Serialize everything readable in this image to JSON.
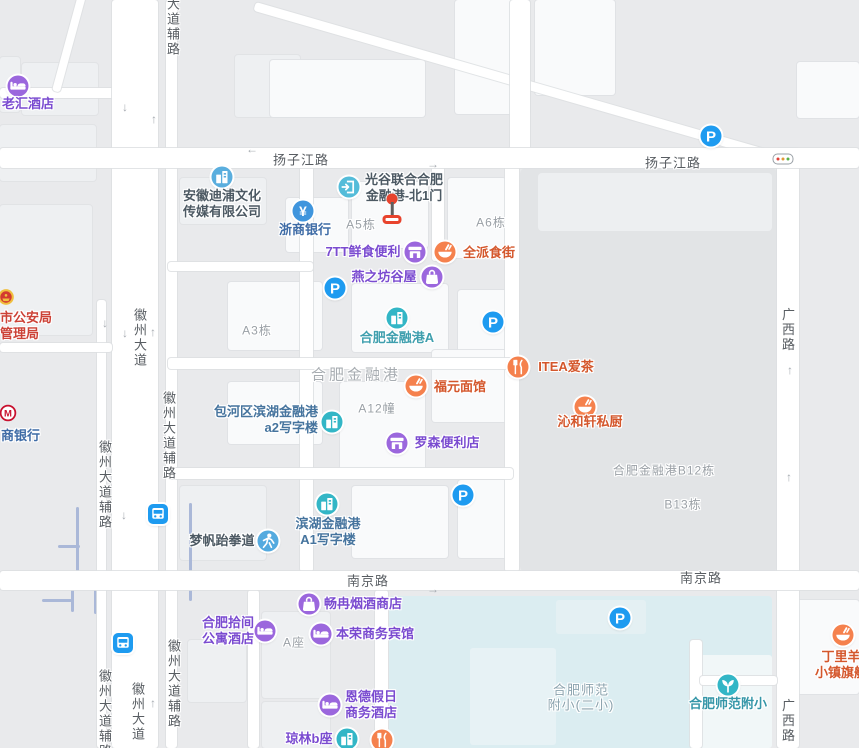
{
  "colors": {
    "purple": "#9b67dd",
    "purple_text": "#7a4bd0",
    "orange": "#f5814d",
    "orange_text": "#d4572c",
    "pblue": "#1e9bf0",
    "teal": "#33b6c6",
    "gateblue": "#54bcd9",
    "cobalt": "#5aaede",
    "bankblue": "#3f95dd",
    "skyblue": "#54aadf",
    "office_text": "#46749e",
    "bank_text": "#3f6ca6",
    "dark_text": "#4c5963",
    "teal_text": "#3f9fae",
    "school_poi_text": "#3596a8",
    "red_text": "#cc4237",
    "area_text": "#9aa0a6",
    "road_text": "#585d62",
    "map_bg": "#e9eaec",
    "block_dark": "#e2e4e6",
    "block_light": "#edeff1",
    "water": "#dbedf1"
  },
  "map": {
    "blocks": [
      {
        "x": 520,
        "y": 168,
        "w": 257,
        "h": 404,
        "c": "#e2e4e6",
        "r": 6
      },
      {
        "x": 538,
        "y": 173,
        "w": 234,
        "h": 58,
        "c": "#edeff1",
        "r": 4
      }
    ],
    "water": [
      {
        "x": 389,
        "y": 596,
        "w": 383,
        "h": 152,
        "c": "#dbedf1",
        "r": 4
      },
      {
        "x": 700,
        "y": 655,
        "w": 72,
        "h": 93,
        "c": "#f1f7f8",
        "r": 3
      },
      {
        "x": 470,
        "y": 648,
        "w": 86,
        "h": 97,
        "c": "#e7f2f5",
        "r": 3
      },
      {
        "x": 556,
        "y": 600,
        "w": 90,
        "h": 34,
        "c": "#e4f0f3",
        "r": 3
      }
    ],
    "buildings": [
      {
        "x": 180,
        "y": 178,
        "w": 86,
        "h": 46,
        "t": 2
      },
      {
        "x": 286,
        "y": 198,
        "w": 62,
        "h": 54,
        "t": 1
      },
      {
        "x": 352,
        "y": 182,
        "w": 76,
        "h": 66,
        "t": 1
      },
      {
        "x": 448,
        "y": 178,
        "w": 58,
        "h": 80,
        "t": 1
      },
      {
        "x": 228,
        "y": 282,
        "w": 94,
        "h": 68,
        "t": 1
      },
      {
        "x": 352,
        "y": 284,
        "w": 96,
        "h": 68,
        "t": 1
      },
      {
        "x": 458,
        "y": 290,
        "w": 54,
        "h": 62,
        "t": 1
      },
      {
        "x": 228,
        "y": 382,
        "w": 94,
        "h": 62,
        "t": 1
      },
      {
        "x": 340,
        "y": 382,
        "w": 85,
        "h": 88,
        "t": 1
      },
      {
        "x": 432,
        "y": 350,
        "w": 86,
        "h": 72,
        "t": 1
      },
      {
        "x": 352,
        "y": 486,
        "w": 96,
        "h": 72,
        "t": 1
      },
      {
        "x": 458,
        "y": 480,
        "w": 57,
        "h": 78,
        "t": 1
      },
      {
        "x": 180,
        "y": 486,
        "w": 86,
        "h": 74,
        "t": 2
      },
      {
        "x": 262,
        "y": 612,
        "w": 68,
        "h": 86,
        "t": 2
      },
      {
        "x": 262,
        "y": 702,
        "w": 68,
        "h": 46,
        "t": 2
      },
      {
        "x": 188,
        "y": 640,
        "w": 58,
        "h": 62,
        "t": 2
      },
      {
        "x": 0,
        "y": 57,
        "w": 20,
        "h": 55,
        "t": 2
      },
      {
        "x": 22,
        "y": 63,
        "w": 76,
        "h": 52,
        "t": 2
      },
      {
        "x": 235,
        "y": 55,
        "w": 65,
        "h": 62,
        "t": 2
      },
      {
        "x": 0,
        "y": 125,
        "w": 96,
        "h": 56,
        "t": 2
      },
      {
        "x": 270,
        "y": 60,
        "w": 155,
        "h": 57,
        "t": 1
      },
      {
        "x": 455,
        "y": 0,
        "w": 75,
        "h": 114,
        "t": 1
      },
      {
        "x": 535,
        "y": 0,
        "w": 80,
        "h": 95,
        "t": 1
      },
      {
        "x": 797,
        "y": 62,
        "w": 62,
        "h": 56,
        "t": 1
      },
      {
        "x": 795,
        "y": 600,
        "w": 64,
        "h": 94,
        "t": 1
      },
      {
        "x": 0,
        "y": 205,
        "w": 92,
        "h": 130,
        "t": 2
      }
    ],
    "paths_light": [
      {
        "x": 42,
        "y": 576,
        "len": 176,
        "v": false
      },
      {
        "x": 58,
        "y": 546,
        "len": 22,
        "v": false
      },
      {
        "x": 42,
        "y": 600,
        "len": 30,
        "v": false
      },
      {
        "x": 77,
        "y": 507,
        "len": 70,
        "v": true
      },
      {
        "x": 147,
        "y": 547,
        "len": 30,
        "v": true
      },
      {
        "x": 190,
        "y": 503,
        "len": 98,
        "v": true
      },
      {
        "x": 95,
        "y": 576,
        "len": 38,
        "v": true
      },
      {
        "x": 72,
        "y": 578,
        "len": 34,
        "v": true
      },
      {
        "x": 122,
        "y": 562,
        "len": 15,
        "v": true
      }
    ],
    "roads": [
      {
        "x": 0,
        "y": 88,
        "w": 118,
        "h": 10
      },
      {
        "x": 86,
        "y": -4,
        "w": 100,
        "h": 8,
        "rot": 105.2
      },
      {
        "x": 256,
        "y": 2,
        "w": 556,
        "h": 9,
        "rot": 16.1
      },
      {
        "x": 510,
        "y": 0,
        "w": 20,
        "h": 150
      },
      {
        "x": 112,
        "y": 0,
        "w": 46,
        "h": 748
      },
      {
        "x": 166,
        "y": 0,
        "w": 11,
        "h": 748
      },
      {
        "x": 97,
        "y": 300,
        "w": 9,
        "h": 448
      },
      {
        "x": 0,
        "y": 343,
        "w": 112,
        "h": 9
      },
      {
        "x": 777,
        "y": 148,
        "w": 22,
        "h": 600
      },
      {
        "x": 300,
        "y": 166,
        "w": 13,
        "h": 406
      },
      {
        "x": 505,
        "y": 166,
        "w": 14,
        "h": 406
      },
      {
        "x": 432,
        "y": 166,
        "w": 12,
        "h": 95
      },
      {
        "x": 168,
        "y": 262,
        "w": 145,
        "h": 9
      },
      {
        "x": 168,
        "y": 358,
        "w": 345,
        "h": 11
      },
      {
        "x": 168,
        "y": 468,
        "w": 345,
        "h": 11
      },
      {
        "x": 375,
        "y": 590,
        "w": 13,
        "h": 158
      },
      {
        "x": 248,
        "y": 590,
        "w": 11,
        "h": 158
      },
      {
        "x": 690,
        "y": 640,
        "w": 12,
        "h": 108
      },
      {
        "x": 700,
        "y": 676,
        "w": 77,
        "h": 9
      },
      {
        "x": 0,
        "y": 148,
        "w": 859,
        "h": 20
      },
      {
        "x": 0,
        "y": 571,
        "w": 859,
        "h": 19
      }
    ],
    "road_labels": [
      {
        "text": "扬子江路",
        "x": 301,
        "y": 159,
        "vert": false
      },
      {
        "text": "扬子江路",
        "x": 673,
        "y": 162,
        "vert": false
      },
      {
        "text": "南京路",
        "x": 368,
        "y": 580,
        "vert": false
      },
      {
        "text": "南京路",
        "x": 701,
        "y": 577,
        "vert": false
      },
      {
        "text": "大道辅路",
        "x": 172,
        "y": 27,
        "vert": true
      },
      {
        "text": "徽州大道",
        "x": 139,
        "y": 338,
        "vert": true
      },
      {
        "text": "徽州大道辅路",
        "x": 168,
        "y": 436,
        "vert": true
      },
      {
        "text": "徽州大道辅路",
        "x": 104,
        "y": 485,
        "vert": true
      },
      {
        "text": "徽州大道辅路",
        "x": 173,
        "y": 684,
        "vert": true
      },
      {
        "text": "徽州大道",
        "x": 137,
        "y": 712,
        "vert": true
      },
      {
        "text": "徽州大道辅路",
        "x": 104,
        "y": 714,
        "vert": true
      },
      {
        "text": "广西路",
        "x": 787,
        "y": 330,
        "vert": true
      },
      {
        "text": "广西路",
        "x": 787,
        "y": 721,
        "vert": true
      }
    ],
    "area_labels": [
      {
        "text": "A5栋",
        "x": 361,
        "y": 224,
        "cls": ""
      },
      {
        "text": "A6栋",
        "x": 491,
        "y": 222,
        "cls": ""
      },
      {
        "text": "A3栋",
        "x": 257,
        "y": 330,
        "cls": ""
      },
      {
        "text": "A12幢",
        "x": 377,
        "y": 408,
        "cls": ""
      },
      {
        "text": "A座",
        "x": 294,
        "y": 642,
        "cls": ""
      },
      {
        "text": "合肥金融港",
        "x": 356,
        "y": 374,
        "cls": "big"
      },
      {
        "text": "合肥金融港B12栋",
        "x": 664,
        "y": 470,
        "cls": ""
      },
      {
        "text": "B13栋",
        "x": 683,
        "y": 504,
        "cls": ""
      },
      {
        "text": "合肥师范",
        "x": 581,
        "y": 689,
        "cls": "school"
      },
      {
        "text": "附小(二小)",
        "x": 581,
        "y": 704,
        "cls": "school"
      }
    ],
    "arrows": [
      {
        "x": 125,
        "y": 107,
        "d": "down"
      },
      {
        "x": 154,
        "y": 119,
        "d": "up"
      },
      {
        "x": 252,
        "y": 149,
        "d": "left"
      },
      {
        "x": 433,
        "y": 164,
        "d": "right"
      },
      {
        "x": 105,
        "y": 323,
        "d": "down"
      },
      {
        "x": 125,
        "y": 333,
        "d": "down"
      },
      {
        "x": 153,
        "y": 332,
        "d": "up"
      },
      {
        "x": 124,
        "y": 515,
        "d": "down"
      },
      {
        "x": 153,
        "y": 703,
        "d": "up"
      },
      {
        "x": 789,
        "y": 477,
        "d": "up"
      },
      {
        "x": 790,
        "y": 370,
        "d": "up"
      },
      {
        "x": 433,
        "y": 589,
        "d": "right"
      }
    ],
    "pois": [
      {
        "name": "laohui-hotel",
        "icon": "bed",
        "bg": "purple",
        "x": 18,
        "y": 86,
        "label": [
          "老汇酒店"
        ],
        "align": "center",
        "lx": 28,
        "ly": 104,
        "tc": "purple_text"
      },
      {
        "name": "anhui-dipu-culture-media",
        "icon": "building",
        "bg": "cobalt",
        "x": 222,
        "y": 177,
        "label": [
          "安徽迪浦文化",
          "传媒有限公司"
        ],
        "align": "center",
        "lx": 222,
        "ly": 196,
        "tc": "dark_text"
      },
      {
        "name": "zheshang-bank",
        "icon": "yen",
        "bg": "bankblue",
        "x": 303,
        "y": 211,
        "label": [
          "浙商银行"
        ],
        "align": "center",
        "lx": 305,
        "ly": 230,
        "tc": "bank_text"
      },
      {
        "name": "guanggu-united-north-gate1",
        "icon": "gate",
        "bg": "gateblue",
        "x": 349,
        "y": 187,
        "label": [
          "光谷联合合肥",
          "金融港-北1门"
        ],
        "align": "center",
        "lx": 404,
        "ly": 180,
        "tc": "dark_text"
      },
      {
        "name": "7tt-fresh-food-store",
        "icon": "store",
        "bg": "purple",
        "x": 415,
        "y": 252,
        "label": [
          "7TT鲜食便利"
        ],
        "align": "center",
        "lx": 363,
        "ly": 252,
        "tc": "purple_text"
      },
      {
        "name": "quanpai-food-street",
        "icon": "bowl",
        "bg": "orange",
        "x": 445,
        "y": 252,
        "label": [
          "全派食街"
        ],
        "align": "center",
        "lx": 489,
        "ly": 253,
        "tc": "orange_text"
      },
      {
        "name": "yanzhifang-guwu",
        "icon": "bag",
        "bg": "purple",
        "x": 432,
        "y": 277,
        "label": [
          "燕之坊谷屋"
        ],
        "align": "center",
        "lx": 384,
        "ly": 277,
        "tc": "purple_text"
      },
      {
        "name": "parking-1",
        "icon": "pletter",
        "bg": "pblue",
        "x": 335,
        "y": 288,
        "label": []
      },
      {
        "name": "parking-2",
        "icon": "pletter",
        "bg": "pblue",
        "x": 493,
        "y": 322,
        "label": []
      },
      {
        "name": "hefei-financial-port-a",
        "icon": "building",
        "bg": "teal",
        "x": 397,
        "y": 318,
        "label": [
          "合肥金融港A"
        ],
        "align": "center",
        "lx": 397,
        "ly": 338,
        "tc": "teal_text"
      },
      {
        "name": "fuyuan-noodle-house",
        "icon": "bowl",
        "bg": "orange",
        "x": 416,
        "y": 386,
        "label": [
          "福元面馆"
        ],
        "align": "center",
        "lx": 460,
        "ly": 387,
        "tc": "orange_text"
      },
      {
        "name": "itea-aicha",
        "icon": "forkknife",
        "bg": "orange",
        "x": 518,
        "y": 367,
        "label": [
          "ITEA爱茶"
        ],
        "align": "center",
        "lx": 566,
        "ly": 367,
        "tc": "orange_text"
      },
      {
        "name": "qinhexuan-private-kitchen",
        "icon": "bowl",
        "bg": "orange",
        "x": 585,
        "y": 407,
        "label": [
          "沁和轩私厨"
        ],
        "align": "center",
        "lx": 590,
        "ly": 422,
        "tc": "orange_text"
      },
      {
        "name": "lawson-store",
        "icon": "store",
        "bg": "purple",
        "x": 397,
        "y": 443,
        "label": [
          "罗森便利店"
        ],
        "align": "center",
        "lx": 447,
        "ly": 443,
        "tc": "purple_text"
      },
      {
        "name": "baohe-binhu-a2-office",
        "icon": "building",
        "bg": "teal",
        "x": 332,
        "y": 422,
        "label": [
          "包河区滨湖金融港",
          "a2写字楼"
        ],
        "align": "right",
        "lx": 318,
        "ly": 412,
        "tc": "office_text"
      },
      {
        "name": "binhu-a1-office",
        "icon": "building",
        "bg": "teal",
        "x": 327,
        "y": 504,
        "label": [
          "滨湖金融港",
          "A1写字楼"
        ],
        "align": "center",
        "lx": 328,
        "ly": 524,
        "tc": "office_text"
      },
      {
        "name": "mengfan-taekwondo",
        "icon": "person",
        "bg": "skyblue",
        "x": 268,
        "y": 541,
        "label": [
          "梦帆跆拳道"
        ],
        "align": "center",
        "lx": 222,
        "ly": 541,
        "tc": "dark_text"
      },
      {
        "name": "parking-3",
        "icon": "pletter",
        "bg": "pblue",
        "x": 463,
        "y": 495,
        "label": []
      },
      {
        "name": "parking-4",
        "icon": "pletter",
        "bg": "pblue",
        "x": 711,
        "y": 136,
        "label": []
      },
      {
        "name": "parking-5",
        "icon": "pletter",
        "bg": "pblue",
        "x": 620,
        "y": 618,
        "label": []
      },
      {
        "name": "bus-station-1",
        "icon": "bus",
        "bg": "pblue",
        "x": 158,
        "y": 514,
        "shape": "square",
        "label": []
      },
      {
        "name": "bus-station-2",
        "icon": "bus",
        "bg": "pblue",
        "x": 123,
        "y": 643,
        "shape": "square",
        "label": []
      },
      {
        "name": "changran-tobacco-wine-shop",
        "icon": "bag",
        "bg": "purple",
        "x": 309,
        "y": 604,
        "label": [
          "畅冉烟酒商店"
        ],
        "align": "center",
        "lx": 363,
        "ly": 604,
        "tc": "purple_text"
      },
      {
        "name": "hefei-shijian-apartment-hotel",
        "icon": "bed",
        "bg": "purple",
        "x": 265,
        "y": 631,
        "label": [
          "合肥拾间",
          "公寓酒店"
        ],
        "align": "center",
        "lx": 228,
        "ly": 623,
        "tc": "purple_text"
      },
      {
        "name": "benrong-business-hotel",
        "icon": "bed",
        "bg": "purple",
        "x": 321,
        "y": 634,
        "label": [
          "本荣商务宾馆"
        ],
        "align": "center",
        "lx": 375,
        "ly": 634,
        "tc": "purple_text"
      },
      {
        "name": "ende-holiday-business-hotel",
        "icon": "bed",
        "bg": "purple",
        "x": 330,
        "y": 705,
        "label": [
          "恩德假日",
          "商务酒店"
        ],
        "align": "center",
        "lx": 371,
        "ly": 697,
        "tc": "purple_text"
      },
      {
        "name": "qionglin-b-block",
        "icon": "building",
        "bg": "teal",
        "x": 347,
        "y": 739,
        "label": [
          "琼林b座"
        ],
        "align": "center",
        "lx": 309,
        "ly": 739,
        "tc": "purple_text"
      },
      {
        "name": "restaurant-unnamed",
        "icon": "forkknife",
        "bg": "orange",
        "x": 382,
        "y": 740,
        "label": []
      },
      {
        "name": "hefei-shifan-fuxiao",
        "icon": "leaf",
        "bg": "teal",
        "x": 728,
        "y": 685,
        "label": [
          "合肥师范附小"
        ],
        "align": "center",
        "lx": 728,
        "ly": 704,
        "tc": "school_poi_text"
      },
      {
        "name": "dingliyang-town-flagship",
        "icon": "bowl",
        "bg": "orange",
        "x": 843,
        "y": 635,
        "label": [
          "丁里羊",
          "小镇旗舰"
        ],
        "align": "center",
        "lx": 841,
        "ly": 657,
        "tc": "orange_text"
      },
      {
        "name": "public-security-bureau",
        "icon": "emblem",
        "bg": "none",
        "x": 6,
        "y": 297,
        "label": [
          "市公安局",
          "管理局"
        ],
        "align": "left",
        "lx": 0,
        "ly": 318,
        "tc": "red_text"
      },
      {
        "name": "merchants-bank",
        "icon": "cmb",
        "bg": "none",
        "x": 8,
        "y": 413,
        "label": [
          "商银行"
        ],
        "align": "left",
        "lx": 1,
        "ly": 436,
        "tc": "bank_text"
      }
    ],
    "marker": {
      "name": "destination-marker",
      "x": 392,
      "y": 199
    },
    "traffic_light": {
      "x": 783,
      "y": 159
    }
  }
}
